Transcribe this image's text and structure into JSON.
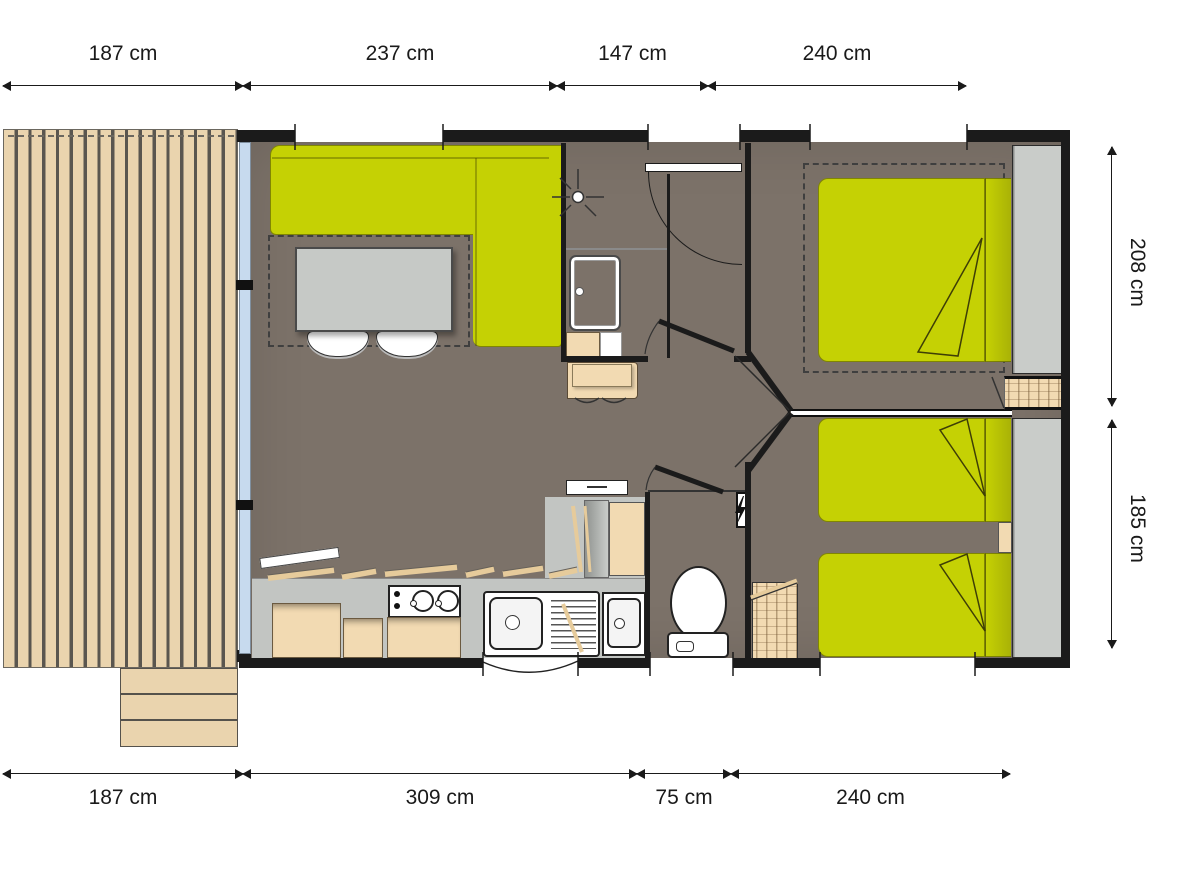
{
  "dimensions": {
    "top": [
      "187 cm",
      "237 cm",
      "147 cm",
      "240 cm"
    ],
    "bottom": [
      "187 cm",
      "309 cm",
      "75 cm",
      "240 cm"
    ],
    "right": [
      "208 cm",
      "185 cm"
    ]
  },
  "colors": {
    "wall": "#1b1b1b",
    "floor": "#7c7269",
    "green": "#c5d104",
    "green_dark": "#a9b206",
    "deck": "#ead4ae",
    "deck_gap": "#5a564f",
    "cabinet": "#f2dab2",
    "cabinet_edge": "#6b5a40",
    "counter": "#c2c5c2",
    "wardrobe": "#c9ccc9",
    "table": "#c6c9c6",
    "glass": "#c7daee",
    "dash": "#3f3f3f",
    "wood_line": "#e6cb9b"
  },
  "icons": [
    "shower-head-icon",
    "lightning-bolt-icon"
  ]
}
